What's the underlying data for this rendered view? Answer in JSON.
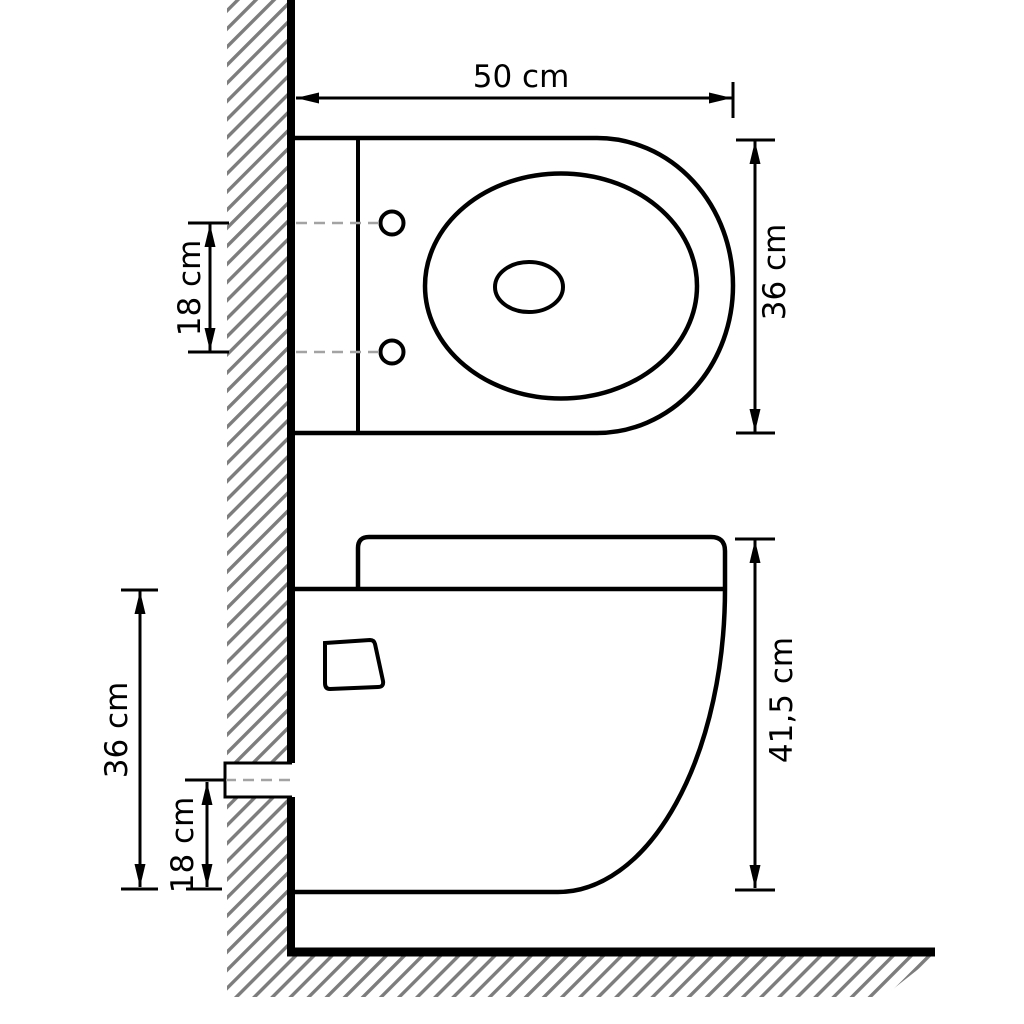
{
  "colors": {
    "line": "#000000",
    "hatch": "#7d7d7d",
    "dashed": "#a3a3a3",
    "background": "#ffffff"
  },
  "top_view": {
    "width_label": "50 cm",
    "depth_label": "36 cm",
    "hole_spacing_label": "18 cm"
  },
  "side_view": {
    "total_height_label": "41,5 cm",
    "bowl_height_label": "36 cm",
    "outlet_offset_label": "18 cm"
  }
}
